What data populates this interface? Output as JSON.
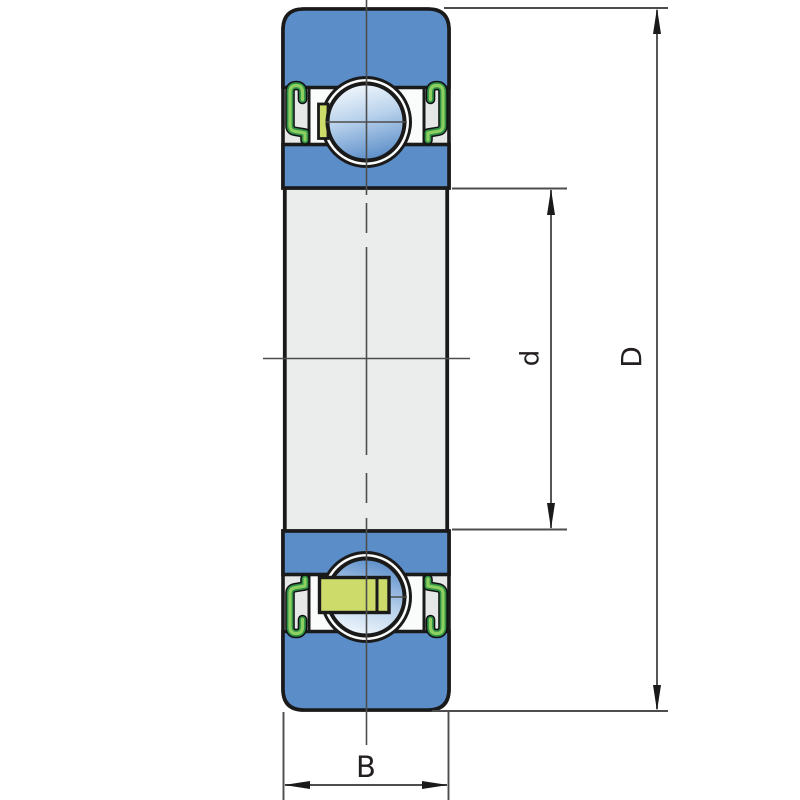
{
  "title": "Sealed deep groove ball bearing cross-section drawing",
  "labels": {
    "width": "B",
    "bore_diameter": "d",
    "outer_diameter": "D"
  },
  "parts": {
    "outer_ring": "outer ring",
    "inner_ring": "inner ring",
    "ball": "ball",
    "seal": "contact seal",
    "cage": "cage",
    "bore": "bore"
  },
  "colors": {
    "ring_blue": "#5b8dc8",
    "ball_light": "#f2f8fd",
    "ball_mid": "#b9d2ec",
    "ball_dark": "#5b8dc8",
    "seal_green_light": "#8ed060",
    "seal_green_dark": "#2f9147",
    "cage_yellow": "#ccdb6a",
    "section_gray": "#e6e8e7",
    "bore_gray": "#ebecec",
    "pocket_white": "#fafbfb",
    "outline_black": "#1a1a1a",
    "line_gray": "#4d4d4d",
    "background": "#ffffff"
  }
}
